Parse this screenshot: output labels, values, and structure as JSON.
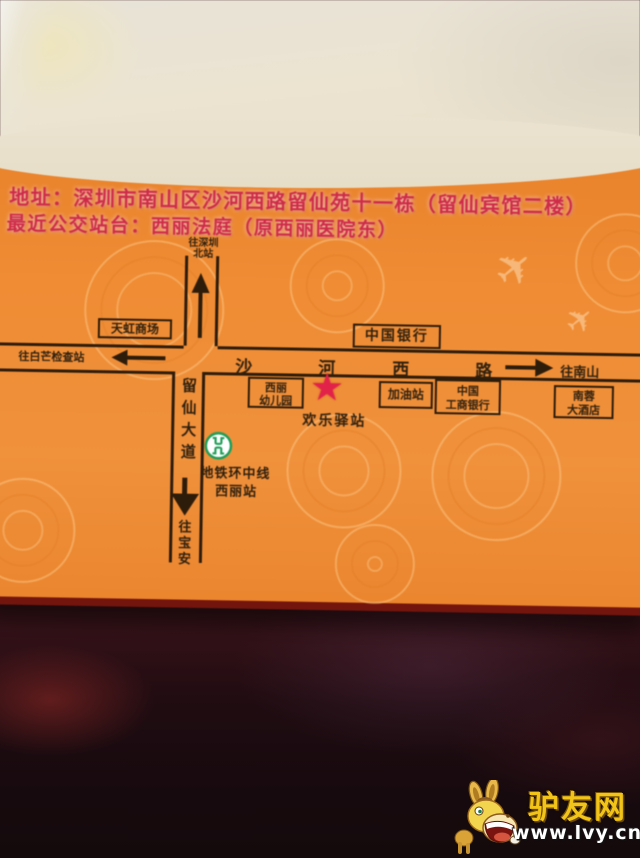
{
  "card": {
    "address_line1": "地址：深圳市南山区沙河西路留仙苑十一栋（留仙宾馆二楼）",
    "address_line2": "最近公交站台：西丽法庭（原西丽医院东）"
  },
  "map": {
    "to_shenzhen_north_line1": "往深圳",
    "to_shenzhen_north_line2": "北站",
    "tianhong_mall": "天虹商场",
    "to_baimang_checkpoint": "往白芒检查站",
    "bank_of_china": "中国银行",
    "road_shahe_chars": [
      "沙",
      "河",
      "西",
      "路"
    ],
    "to_nanshan": "往南山",
    "xili_kindergarten_line1": "西丽",
    "xili_kindergarten_line2": "幼儿园",
    "happy_station": "欢乐驿站",
    "gas_station": "加油站",
    "icbc_line1": "中国",
    "icbc_line2": "工商银行",
    "nanrong_hotel_line1": "南蓉",
    "nanrong_hotel_line2": "大酒店",
    "liuxian_avenue": "留仙大道",
    "to_baoan": "往宝安",
    "metro_line": "地铁环中线",
    "metro_station": "西丽站",
    "star_glyph": "★",
    "airplane_glyph": "✈"
  },
  "watermark": {
    "site_name": "驴友网",
    "url": "www.lvy.cn"
  },
  "colors": {
    "card_orange": "#ee8a33",
    "map_ink": "#2e1c0a",
    "address_red": "#ce2b47",
    "star_red": "#e3224a",
    "metro_green": "#1e9e57",
    "watermark_gold": "#f2c419",
    "card_edge_red": "#74150d"
  }
}
